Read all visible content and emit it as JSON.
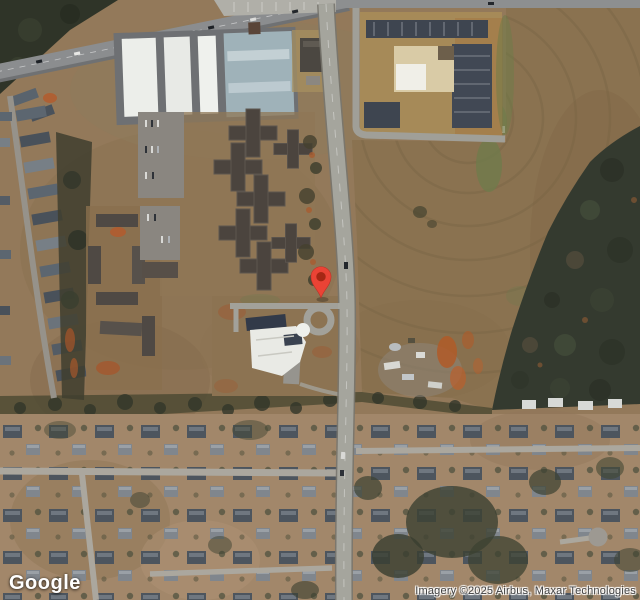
{
  "map": {
    "type": "satellite",
    "logo_text": "Google",
    "attribution": "Imagery ©2025 Airbus, Maxar Technologies"
  },
  "marker": {
    "color": "#EA4335",
    "inner_color": "#A52714",
    "x": 321,
    "y": 298
  },
  "palette": {
    "ground_tan": "#93795a",
    "field_brown": "#8a7250",
    "forest_dark": "#343a2f",
    "road_gray": "#a5a59d",
    "highway_gray": "#8b8d8f",
    "warehouse_roof_white": "#eceeea",
    "warehouse_roof_bluegray": "#9fb2b9",
    "campus_roof": "#4b443e",
    "school_roof_white": "#e9eae5",
    "school_roof_navy": "#323a49",
    "orange_dirt": "#b05a28"
  }
}
